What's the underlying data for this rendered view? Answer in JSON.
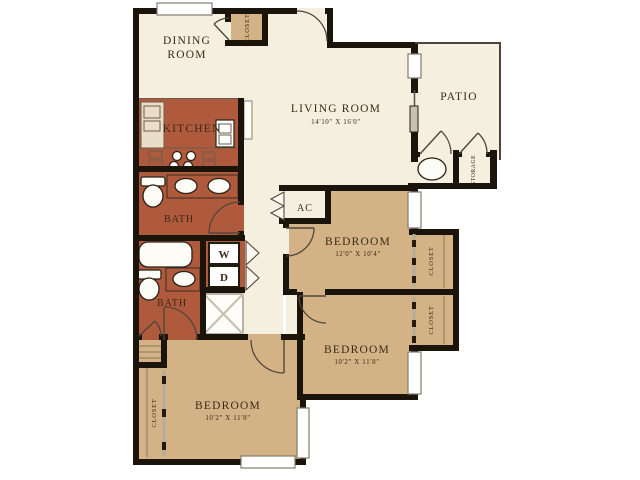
{
  "plan": {
    "rooms": {
      "dining": {
        "line1": "DINING",
        "line2": "ROOM"
      },
      "kitchen": {
        "name": "KITCHEN"
      },
      "living": {
        "name": "LIVING ROOM",
        "dims": "14'10\" X 16'0\""
      },
      "patio": {
        "name": "PATIO"
      },
      "ac_closet": {
        "name": "AC"
      },
      "bath_upper": {
        "name": "BATH"
      },
      "bath_lower": {
        "name": "BATH"
      },
      "bedroom_right_upper": {
        "name": "BEDROOM",
        "dims": "12'0\" X 10'4\""
      },
      "bedroom_right_lower": {
        "name": "BEDROOM",
        "dims": "10'2\" X 11'8\""
      },
      "bedroom_left": {
        "name": "BEDROOM",
        "dims": "10'2\" X 11'8\""
      }
    },
    "closets": {
      "entry": "CLOSET",
      "bedroom_right_upper": "CLOSET",
      "bedroom_right_lower": "CLOSET",
      "bedroom_left": "CLOSET",
      "storage": "STORAGE"
    },
    "laundry": {
      "washer": "W",
      "dryer": "D"
    },
    "colors": {
      "walls": "#1a140b",
      "kitchen_and_baths": "#b05a3d",
      "bedrooms_and_closets": "#d3b286",
      "living_areas": "#f4efdf",
      "background": "#ffffff",
      "label_text": "#3a2a18"
    }
  }
}
